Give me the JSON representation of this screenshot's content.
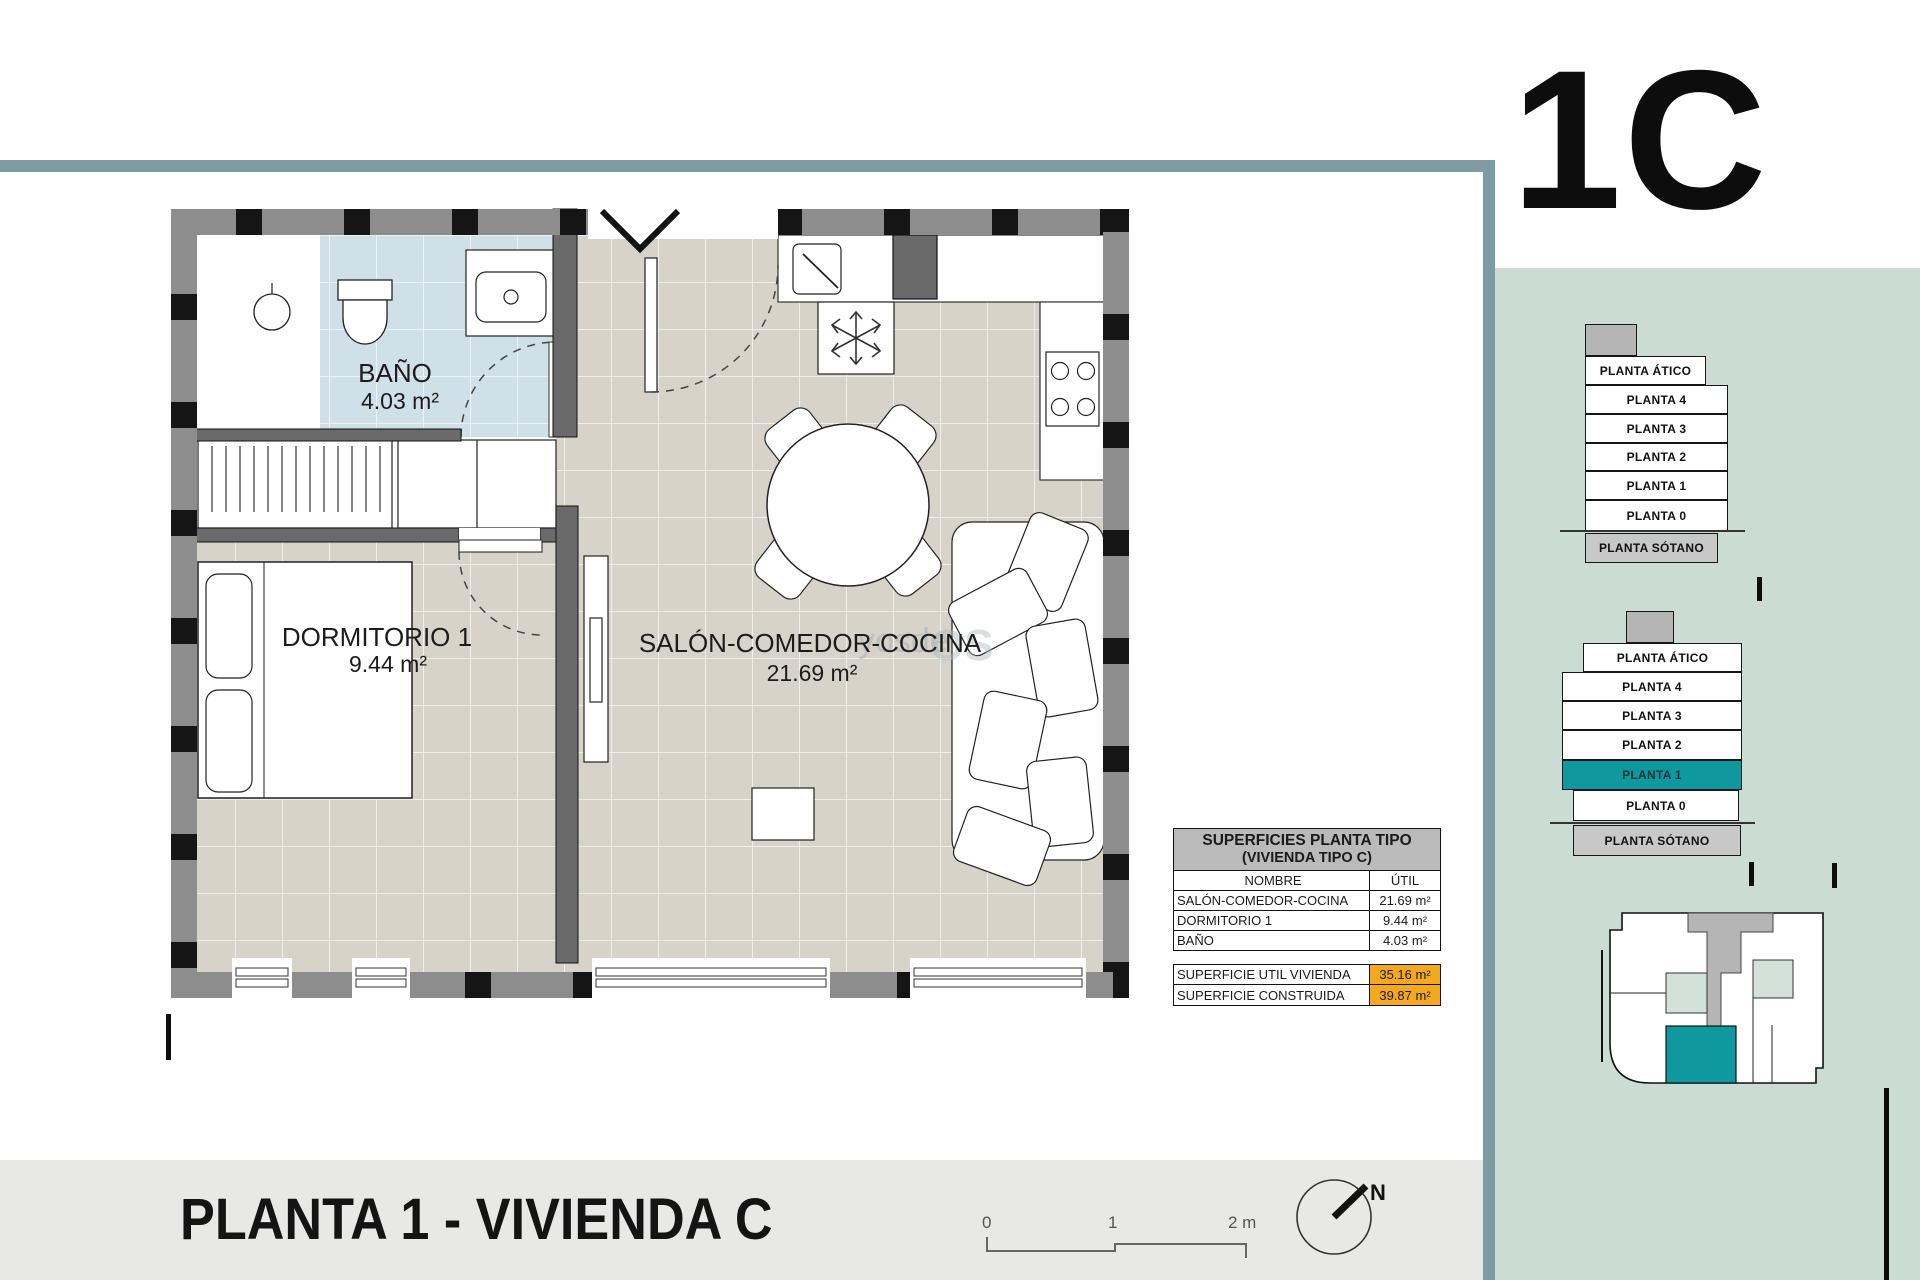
{
  "unit_code": "1C",
  "sheet_title": "PLANTA 1 - VIVIENDA C",
  "watermark": {
    "frag1": "yosde",
    "frag2": "OS"
  },
  "plan": {
    "rooms": [
      {
        "name": "BAÑO",
        "area": "4.03 m²"
      },
      {
        "name": "DORMITORIO 1",
        "area": "9.44 m²"
      },
      {
        "name": "SALÓN-COMEDOR-COCINA",
        "area": "21.69 m²"
      }
    ]
  },
  "surfaces_table": {
    "title_line1": "SUPERFICIES PLANTA TIPO",
    "title_line2": "(VIVIENDA TIPO C)",
    "col_name": "NOMBRE",
    "col_util": "ÚTIL",
    "rows": [
      {
        "name": "SALÓN-COMEDOR-COCINA",
        "util": "21.69 m²"
      },
      {
        "name": "DORMITORIO 1",
        "util": "9.44 m²"
      },
      {
        "name": "BAÑO",
        "util": "4.03 m²"
      }
    ],
    "totals": [
      {
        "name": "SUPERFICIE UTIL VIVIENDA",
        "util": "35.16 m²"
      },
      {
        "name": "SUPERFICIE CONSTRUIDA",
        "util": "39.87 m²"
      }
    ]
  },
  "floor_stacks": {
    "top": {
      "floors": [
        "PLANTA ÁTICO",
        "PLANTA 4",
        "PLANTA 3",
        "PLANTA 2",
        "PLANTA 1",
        "PLANTA 0",
        "PLANTA SÓTANO"
      ]
    },
    "bottom": {
      "floors": [
        "PLANTA ÁTICO",
        "PLANTA 4",
        "PLANTA 3",
        "PLANTA 2",
        "PLANTA 1",
        "PLANTA 0",
        "PLANTA SÓTANO"
      ],
      "highlighted": "PLANTA 1"
    }
  },
  "scale_bar": {
    "labels": [
      "0",
      "1",
      "2 m"
    ]
  },
  "north_label": "N",
  "colors": {
    "accent_teal": "#0f999e",
    "frame_rule": "#7f9ba2",
    "panel_green": "#cadcd3",
    "highlight_orange": "#f3a81d",
    "bath_tile": "#d0e0e8",
    "floor_tile": "#d7d3c9"
  }
}
